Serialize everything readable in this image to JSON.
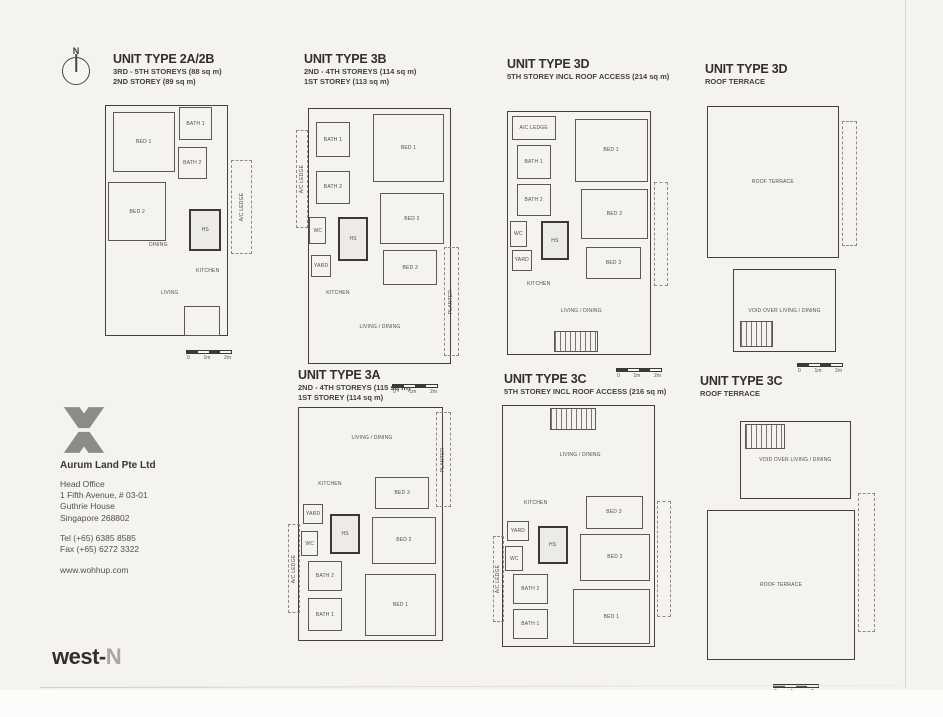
{
  "compass": {
    "label": "N"
  },
  "scale_bar": {
    "labels": [
      "0",
      "1m",
      "2m"
    ]
  },
  "company": {
    "name": "Aurum Land Pte Ltd",
    "office_label": "Head Office",
    "address_lines": [
      "1 Fifth Avenue, # 03-01",
      "Guthrie House",
      "Singapore 268802"
    ],
    "tel": "Tel (+65) 6385 8585",
    "fax": "Fax (+65) 6272 3322",
    "website": "www.wohhup.com"
  },
  "brand": {
    "dark": "west-",
    "light": "N"
  },
  "units": [
    {
      "id": "2a2b",
      "title": "UNIT TYPE 2A/2B",
      "lines": [
        "3RD - 5TH STOREYS (88 sq m)",
        "2ND STOREY (89 sq m)"
      ],
      "rooms": [
        {
          "label": "",
          "x": 3,
          "y": 2,
          "w": 76,
          "h": 93,
          "style": "outer"
        },
        {
          "label": "BED 1",
          "x": 8,
          "y": 5,
          "w": 38,
          "h": 24,
          "style": "solid"
        },
        {
          "label": "BATH 1",
          "x": 49,
          "y": 3,
          "w": 20,
          "h": 13,
          "style": "solid"
        },
        {
          "label": "BATH 2",
          "x": 48,
          "y": 19,
          "w": 18,
          "h": 13,
          "style": "solid"
        },
        {
          "label": "BED 2",
          "x": 5,
          "y": 33,
          "w": 36,
          "h": 24,
          "style": "solid"
        },
        {
          "label": "HS",
          "x": 55,
          "y": 44,
          "w": 20,
          "h": 17,
          "style": "thick"
        },
        {
          "label": "A/C LEDGE",
          "x": 81,
          "y": 24,
          "w": 13,
          "h": 38,
          "style": "dashed",
          "rot": true
        },
        {
          "label": "DINING",
          "x": 25,
          "y": 53,
          "w": 22,
          "h": 11,
          "style": "none"
        },
        {
          "label": "KITCHEN",
          "x": 55,
          "y": 57,
          "w": 23,
          "h": 24,
          "style": "none"
        },
        {
          "label": "LIVING",
          "x": 29,
          "y": 69,
          "w": 28,
          "h": 18,
          "style": "none"
        },
        {
          "label": "",
          "x": 52,
          "y": 83,
          "w": 22,
          "h": 12,
          "style": "solid"
        }
      ]
    },
    {
      "id": "3b",
      "title": "UNIT TYPE 3B",
      "lines": [
        "2ND - 4TH STOREYS (114 sq m)",
        "1ST STOREY (113 sq m)"
      ],
      "rooms": [
        {
          "label": "",
          "x": 7,
          "y": 2,
          "w": 85,
          "h": 94,
          "style": "outer"
        },
        {
          "label": "A/C LEDGE",
          "x": 0,
          "y": 10,
          "w": 7,
          "h": 36,
          "style": "dashed",
          "rot": true
        },
        {
          "label": "BATH 1",
          "x": 12,
          "y": 7,
          "w": 20,
          "h": 13,
          "style": "solid"
        },
        {
          "label": "BED 1",
          "x": 46,
          "y": 4,
          "w": 42,
          "h": 25,
          "style": "solid"
        },
        {
          "label": "BATH 2",
          "x": 12,
          "y": 25,
          "w": 20,
          "h": 12,
          "style": "solid"
        },
        {
          "label": "WC",
          "x": 8,
          "y": 42,
          "w": 10,
          "h": 10,
          "style": "solid"
        },
        {
          "label": "HS",
          "x": 25,
          "y": 42,
          "w": 18,
          "h": 16,
          "style": "thick"
        },
        {
          "label": "YARD",
          "x": 9,
          "y": 56,
          "w": 12,
          "h": 8,
          "style": "solid"
        },
        {
          "label": "BED 2",
          "x": 50,
          "y": 33,
          "w": 38,
          "h": 19,
          "style": "solid"
        },
        {
          "label": "KITCHEN",
          "x": 13,
          "y": 64,
          "w": 24,
          "h": 12,
          "style": "none"
        },
        {
          "label": "BED 3",
          "x": 52,
          "y": 54,
          "w": 32,
          "h": 13,
          "style": "solid"
        },
        {
          "label": "LIVING / DINING",
          "x": 22,
          "y": 72,
          "w": 56,
          "h": 21,
          "style": "none"
        },
        {
          "label": "PLANTER",
          "x": 88,
          "y": 53,
          "w": 9,
          "h": 40,
          "style": "dashed",
          "rot": true
        }
      ]
    },
    {
      "id": "3d",
      "title": "UNIT TYPE 3D",
      "lines": [
        "5TH STOREY INCL ROOF ACCESS (214 sq m)"
      ],
      "rooms": [
        {
          "label": "",
          "x": 5,
          "y": 3,
          "w": 85,
          "h": 93,
          "style": "outer"
        },
        {
          "label": "A/C LEDGE",
          "x": 8,
          "y": 5,
          "w": 26,
          "h": 9,
          "style": "solid"
        },
        {
          "label": "BATH 1",
          "x": 11,
          "y": 16,
          "w": 20,
          "h": 13,
          "style": "solid"
        },
        {
          "label": "BED 1",
          "x": 45,
          "y": 6,
          "w": 43,
          "h": 24,
          "style": "solid"
        },
        {
          "label": "BATH 2",
          "x": 11,
          "y": 31,
          "w": 20,
          "h": 12,
          "style": "solid"
        },
        {
          "label": "WC",
          "x": 7,
          "y": 45,
          "w": 10,
          "h": 10,
          "style": "solid"
        },
        {
          "label": "HS",
          "x": 25,
          "y": 45,
          "w": 17,
          "h": 15,
          "style": "thick"
        },
        {
          "label": "YARD",
          "x": 8,
          "y": 56,
          "w": 12,
          "h": 8,
          "style": "solid"
        },
        {
          "label": "BED 2",
          "x": 49,
          "y": 33,
          "w": 39,
          "h": 19,
          "style": "solid"
        },
        {
          "label": "KITCHEN",
          "x": 12,
          "y": 63,
          "w": 24,
          "h": 12,
          "style": "none"
        },
        {
          "label": "BED 3",
          "x": 52,
          "y": 55,
          "w": 32,
          "h": 12,
          "style": "solid"
        },
        {
          "label": "LIVING / DINING",
          "x": 24,
          "y": 71,
          "w": 50,
          "h": 17,
          "style": "none"
        },
        {
          "label": "",
          "x": 33,
          "y": 87,
          "w": 26,
          "h": 8,
          "style": "stairs"
        },
        {
          "label": "",
          "x": 92,
          "y": 30,
          "w": 8,
          "h": 40,
          "style": "dashed"
        }
      ]
    },
    {
      "id": "3d-roof",
      "title": "UNIT TYPE 3D",
      "lines": [
        "ROOF TERRACE"
      ],
      "rooms": [
        {
          "label": "ROOF TERRACE",
          "x": 6,
          "y": 5,
          "w": 80,
          "h": 53,
          "style": "outer"
        },
        {
          "label": "VOID OVER LIVING / DINING",
          "x": 22,
          "y": 62,
          "w": 62,
          "h": 29,
          "style": "outer"
        },
        {
          "label": "",
          "x": 26,
          "y": 80,
          "w": 20,
          "h": 9,
          "style": "stairs"
        },
        {
          "label": "",
          "x": 88,
          "y": 10,
          "w": 9,
          "h": 44,
          "style": "dashed"
        }
      ]
    },
    {
      "id": "3a",
      "title": "UNIT TYPE 3A",
      "lines": [
        "2ND - 4TH STOREYS (115 sq m)",
        "1ST STOREY (114 sq m)"
      ],
      "rooms": [
        {
          "label": "",
          "x": 6,
          "y": 3,
          "w": 86,
          "h": 94,
          "style": "outer"
        },
        {
          "label": "LIVING / DINING",
          "x": 22,
          "y": 5,
          "w": 56,
          "h": 21,
          "style": "none"
        },
        {
          "label": "PLANTER",
          "x": 88,
          "y": 5,
          "w": 9,
          "h": 38,
          "style": "dashed",
          "rot": true
        },
        {
          "label": "KITCHEN",
          "x": 13,
          "y": 28,
          "w": 24,
          "h": 12,
          "style": "none"
        },
        {
          "label": "BED 3",
          "x": 52,
          "y": 31,
          "w": 32,
          "h": 13,
          "style": "solid"
        },
        {
          "label": "YARD",
          "x": 9,
          "y": 42,
          "w": 12,
          "h": 8,
          "style": "solid"
        },
        {
          "label": "HS",
          "x": 25,
          "y": 46,
          "w": 18,
          "h": 16,
          "style": "thick"
        },
        {
          "label": "WC",
          "x": 8,
          "y": 53,
          "w": 10,
          "h": 10,
          "style": "solid"
        },
        {
          "label": "BED 2",
          "x": 50,
          "y": 47,
          "w": 38,
          "h": 19,
          "style": "solid"
        },
        {
          "label": "BATH 2",
          "x": 12,
          "y": 65,
          "w": 20,
          "h": 12,
          "style": "solid"
        },
        {
          "label": "BATH 1",
          "x": 12,
          "y": 80,
          "w": 20,
          "h": 13,
          "style": "solid"
        },
        {
          "label": "BED 1",
          "x": 46,
          "y": 70,
          "w": 42,
          "h": 25,
          "style": "solid"
        },
        {
          "label": "A/C LEDGE",
          "x": 0,
          "y": 50,
          "w": 7,
          "h": 36,
          "style": "dashed",
          "rot": true
        }
      ]
    },
    {
      "id": "3c",
      "title": "UNIT TYPE 3C",
      "lines": [
        "5TH STOREY INCL ROOF ACCESS (216 sq m)"
      ],
      "rooms": [
        {
          "label": "",
          "x": 5,
          "y": 2,
          "w": 86,
          "h": 96,
          "style": "outer"
        },
        {
          "label": "",
          "x": 32,
          "y": 3,
          "w": 26,
          "h": 9,
          "style": "stairs"
        },
        {
          "label": "LIVING / DINING",
          "x": 24,
          "y": 12,
          "w": 50,
          "h": 20,
          "style": "none"
        },
        {
          "label": "KITCHEN",
          "x": 12,
          "y": 35,
          "w": 24,
          "h": 12,
          "style": "none"
        },
        {
          "label": "BED 3",
          "x": 52,
          "y": 38,
          "w": 32,
          "h": 13,
          "style": "solid"
        },
        {
          "label": "YARD",
          "x": 8,
          "y": 48,
          "w": 12,
          "h": 8,
          "style": "solid"
        },
        {
          "label": "HS",
          "x": 25,
          "y": 50,
          "w": 17,
          "h": 15,
          "style": "thick"
        },
        {
          "label": "WC",
          "x": 7,
          "y": 58,
          "w": 10,
          "h": 10,
          "style": "solid"
        },
        {
          "label": "BED 2",
          "x": 49,
          "y": 53,
          "w": 39,
          "h": 19,
          "style": "solid"
        },
        {
          "label": "BATH 2",
          "x": 11,
          "y": 69,
          "w": 20,
          "h": 12,
          "style": "solid"
        },
        {
          "label": "BATH 1",
          "x": 11,
          "y": 83,
          "w": 20,
          "h": 12,
          "style": "solid"
        },
        {
          "label": "BED 1",
          "x": 45,
          "y": 75,
          "w": 43,
          "h": 22,
          "style": "solid"
        },
        {
          "label": "A/C LEDGE",
          "x": 0,
          "y": 54,
          "w": 6,
          "h": 34,
          "style": "dashed",
          "rot": true
        },
        {
          "label": "",
          "x": 92,
          "y": 40,
          "w": 8,
          "h": 46,
          "style": "dashed"
        }
      ]
    },
    {
      "id": "3c-roof",
      "title": "UNIT TYPE 3C",
      "lines": [
        "ROOF TERRACE"
      ],
      "rooms": [
        {
          "label": "VOID OVER LIVING / DINING",
          "x": 22,
          "y": 4,
          "w": 62,
          "h": 28,
          "style": "outer"
        },
        {
          "label": "",
          "x": 25,
          "y": 5,
          "w": 22,
          "h": 9,
          "style": "stairs"
        },
        {
          "label": "ROOF TERRACE",
          "x": 4,
          "y": 36,
          "w": 82,
          "h": 54,
          "style": "outer"
        },
        {
          "label": "",
          "x": 88,
          "y": 30,
          "w": 9,
          "h": 50,
          "style": "dashed"
        }
      ]
    }
  ]
}
